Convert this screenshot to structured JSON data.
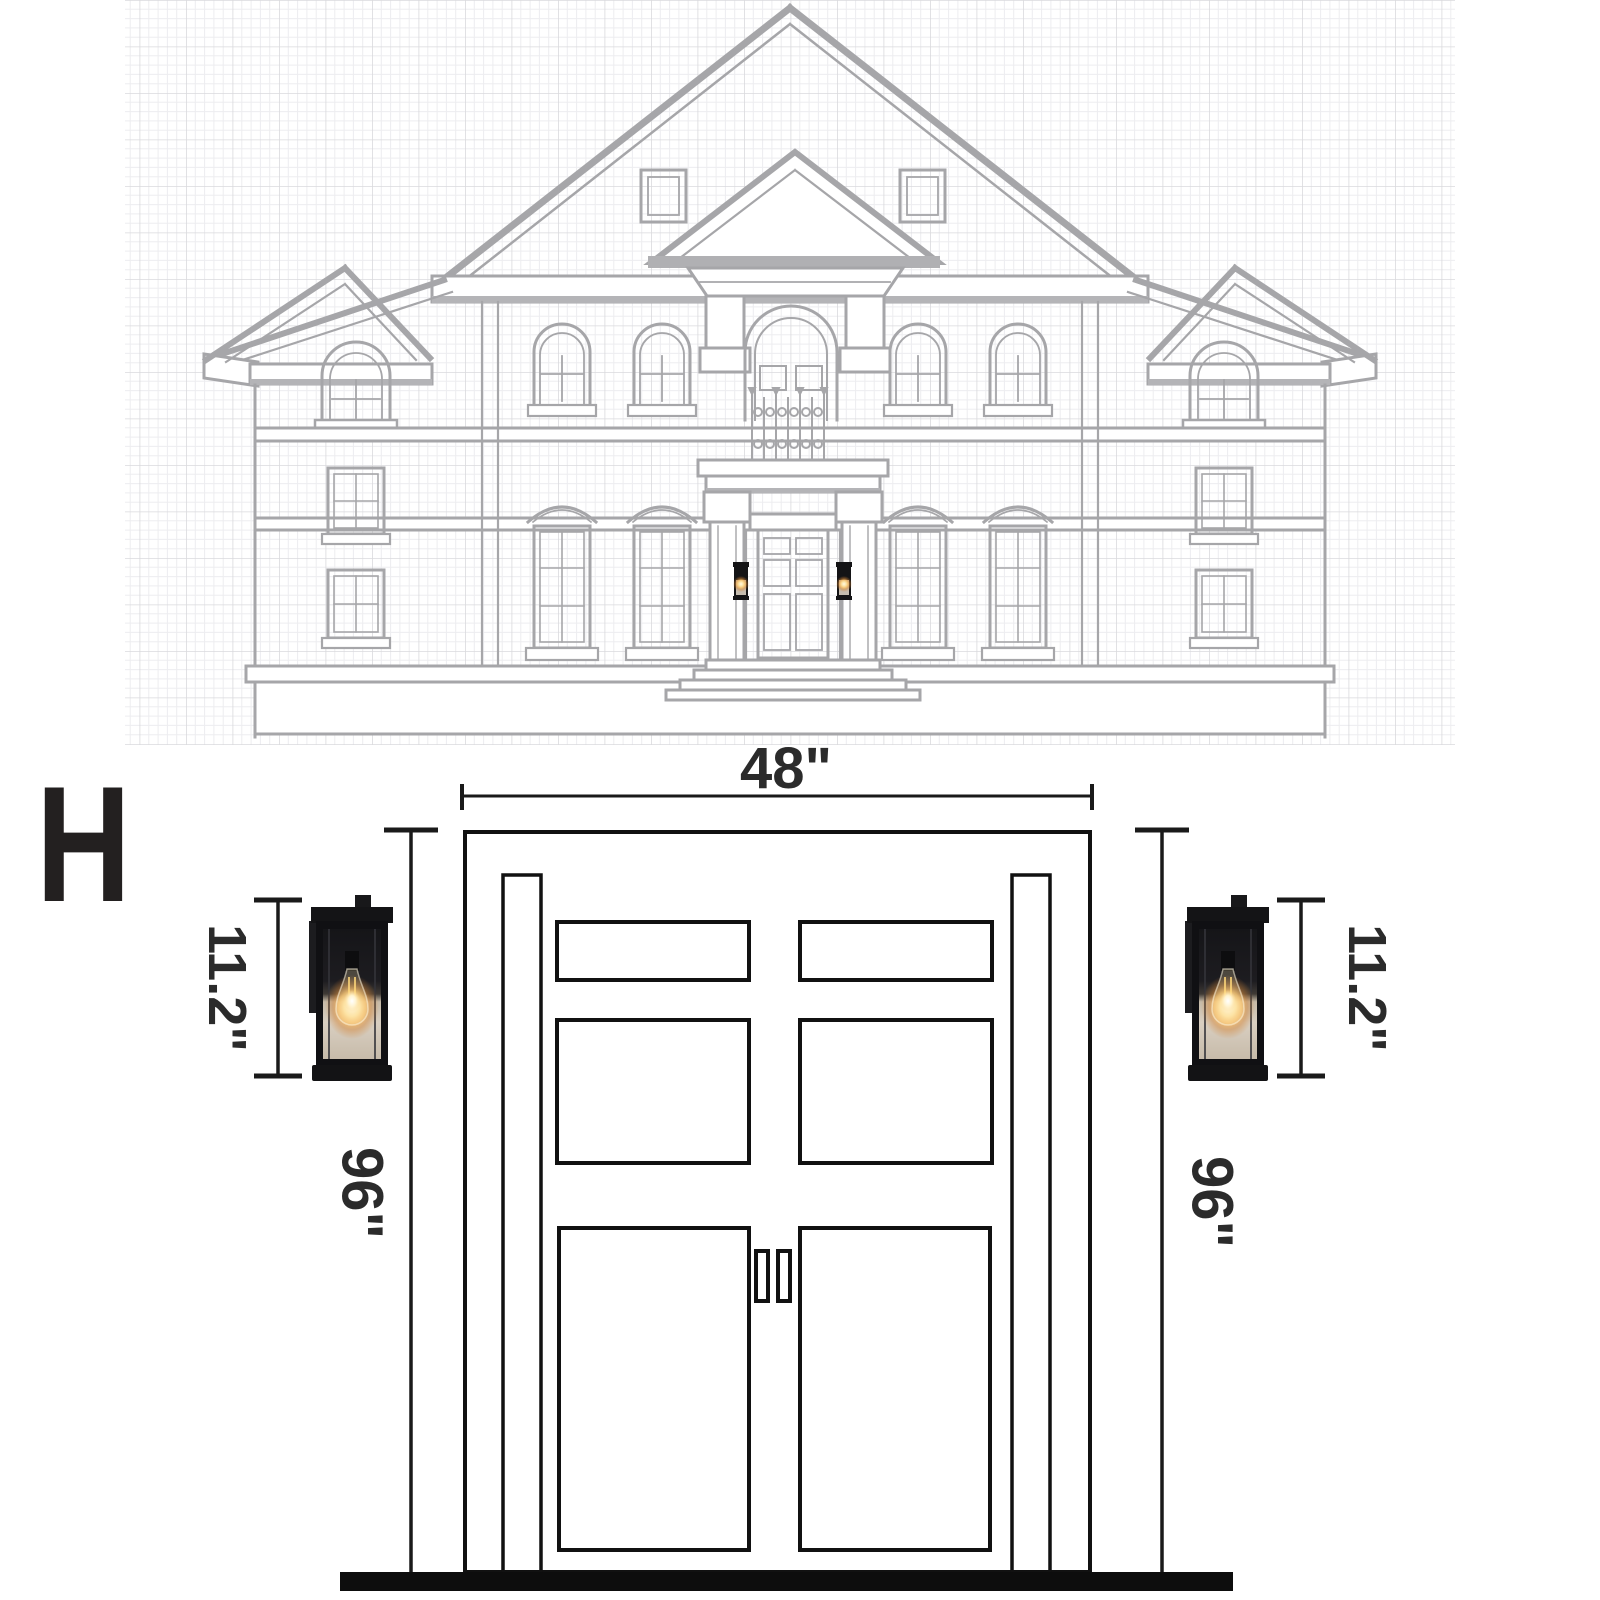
{
  "illustration": {
    "scene": "house-front-elevation-blueprint",
    "line_color": "#a6a6a9",
    "grid_minor_color": "#ededf0",
    "grid_major_color": "#dadadd",
    "sconce_glow_color": "#ffc95e"
  },
  "diagram": {
    "variant_label": "H",
    "door": {
      "width_label": "48\"",
      "width_in": 48,
      "height_label_left": "96\"",
      "height_label_right": "96\"",
      "height_in": 96
    },
    "sconce": {
      "height_label_left": "11.2\"",
      "height_label_right": "11.2\"",
      "height_in": 11.2
    },
    "colors": {
      "line": "#111111",
      "text": "#2b2b2b",
      "threshold_bar": "#0d0d0d",
      "fixture_body": "#131315"
    }
  }
}
